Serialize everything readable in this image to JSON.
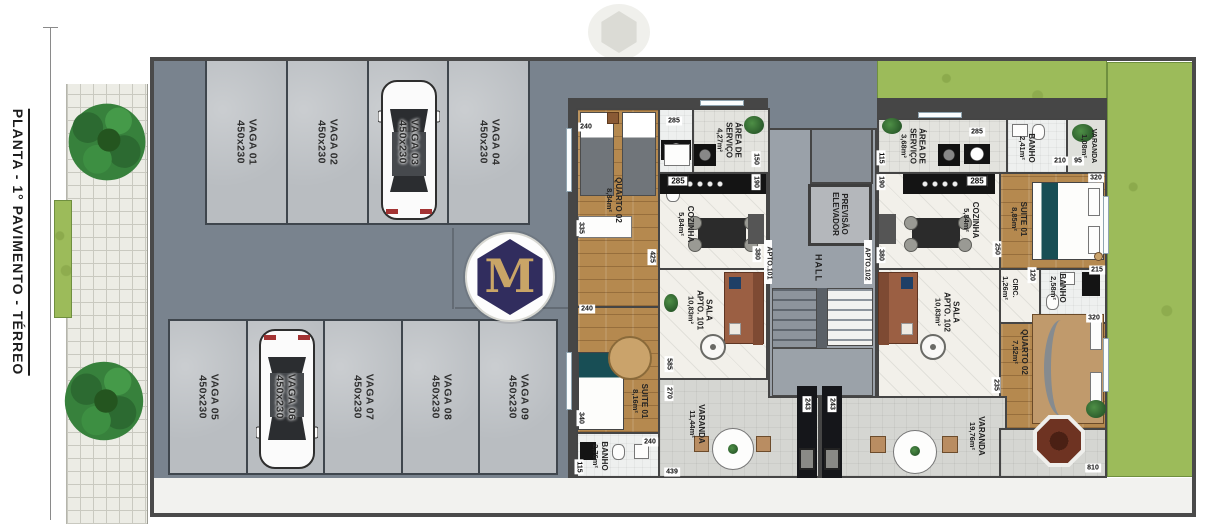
{
  "title": "PLANTA - 1° PAVIMENTO - TÉRREO",
  "logo_letter": "M",
  "parking": {
    "stalls_top": [
      {
        "name": "VAGA 01",
        "size": "450x230"
      },
      {
        "name": "VAGA 02",
        "size": "450x230"
      },
      {
        "name": "VAGA 03",
        "size": "450x230"
      },
      {
        "name": "VAGA 04",
        "size": "450x230"
      }
    ],
    "stalls_bottom": [
      {
        "name": "VAGA 05",
        "size": "450x230"
      },
      {
        "name": "VAGA 06",
        "size": "450x230"
      },
      {
        "name": "VAGA 07",
        "size": "450x230"
      },
      {
        "name": "VAGA 08",
        "size": "450x230"
      },
      {
        "name": "VAGA 09",
        "size": "450x230"
      }
    ]
  },
  "core": {
    "elevator": "PREVISÃO\nELEVADOR",
    "hall": "HALL",
    "door_101": "APTO.101",
    "door_102": "APTO.102"
  },
  "apt101": {
    "quarto02": {
      "name": "QUARTO 02",
      "area": "8,84m²"
    },
    "servico": {
      "name": "ÁREA DE\nSERVIÇO",
      "area": "4,27m²"
    },
    "cozinha": {
      "name": "COZINHA",
      "area": "5,84m²"
    },
    "sala": {
      "name": "SALA\nAPTO. 101",
      "area": "10,83m²"
    },
    "suite": {
      "name": "SUITE 01",
      "area": "8,16m²"
    },
    "banho": {
      "name": "BANHO",
      "area": "2,76m²"
    },
    "varanda": {
      "name": "VARANDA",
      "area": "11,44m²"
    }
  },
  "apt102": {
    "servico": {
      "name": "ÁREA DE\nSERVIÇO",
      "area": "3,68m²"
    },
    "cozinha": {
      "name": "COZINHA",
      "area": "5,84m²"
    },
    "sala": {
      "name": "SALA\nAPTO. 102",
      "area": "10,83m²"
    },
    "banho_suite": {
      "name": "BANHO",
      "area": "2,41m²"
    },
    "varanda_suite": {
      "name": "VARANDA",
      "area": "1,08m²"
    },
    "suite": {
      "name": "SUITE 01",
      "area": "8,85m²"
    },
    "circ": {
      "name": "CIRC.",
      "area": "1,26m²"
    },
    "banho": {
      "name": "BANHO",
      "area": "2,58m²"
    },
    "quarto02": {
      "name": "QUARTO 02",
      "area": "7,52m²"
    },
    "varanda": {
      "name": "VARANDA",
      "area": "19,76m²"
    }
  },
  "dims": [
    "240",
    "285",
    "150",
    "190",
    "285",
    "335",
    "425",
    "380",
    "240",
    "585",
    "270",
    "340",
    "240",
    "115",
    "439",
    "243",
    "243",
    "115",
    "190",
    "285",
    "285",
    "380",
    "250",
    "210",
    "95",
    "320",
    "120",
    "215",
    "320",
    "235",
    "810"
  ],
  "colors": {
    "navy": "#312d5e",
    "gold": "#c9a567",
    "grass": "#9cbb5a",
    "driveway": "#79838e",
    "wood": "#b5894f",
    "wall": "#4a4a4a"
  }
}
